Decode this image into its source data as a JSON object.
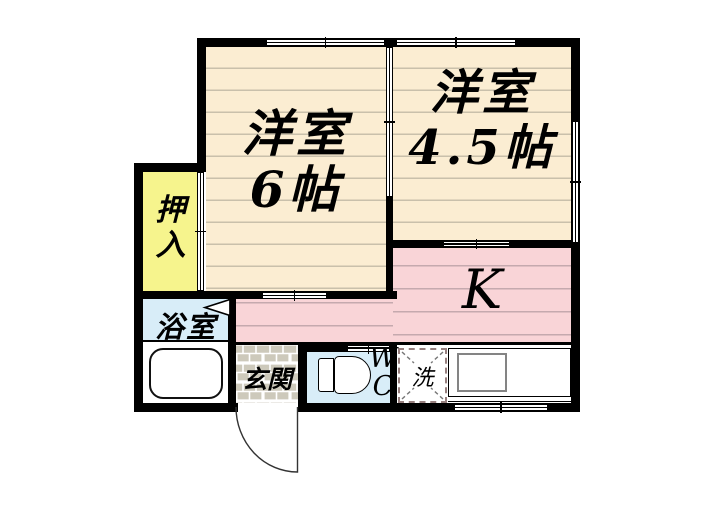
{
  "plan": {
    "type": "apartment-floor-plan",
    "rooms": {
      "west6": {
        "name": "洋室",
        "size": "6帖"
      },
      "west45": {
        "name": "洋室",
        "size": "4.5帖"
      },
      "kitchen": {
        "label": "K"
      },
      "closet": {
        "char1": "押",
        "char2": "入"
      },
      "bath": {
        "label": "浴室"
      },
      "entrance": {
        "label": "玄関"
      },
      "wc": {
        "char1": "W",
        "char2": "C"
      },
      "laundry": {
        "label": "洗"
      }
    },
    "colors": {
      "wall": "#000000",
      "wood_floor": "#FBEDD2",
      "wood_stripe": "#C9C0AB",
      "kitchen_floor": "#F9D4D7",
      "kitchen_stripe": "#C5A9AE",
      "closet": "#F6F48D",
      "water_rooms": "#D8EDF8",
      "entrance_tile": "#CDC9BB",
      "fixture_outline": "#000000"
    }
  }
}
